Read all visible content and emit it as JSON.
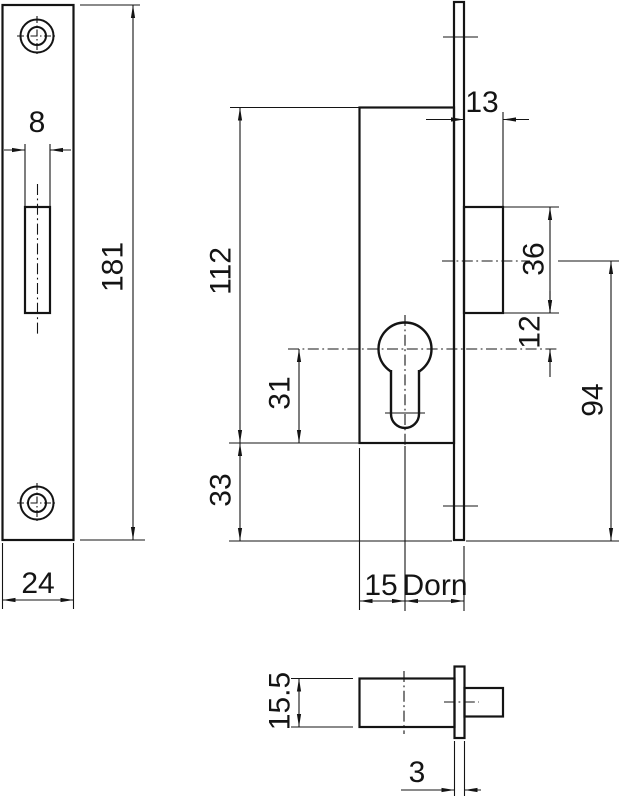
{
  "page": {
    "background": "#ffffff",
    "line_color": "#141414",
    "description": "Technical drawing of a narrow-stile mortise deadbolt lock with strike plate, front view and side view, dimensions in mm"
  },
  "views": {
    "strike_plate": {
      "title": "strike-plate-front-view",
      "dims": {
        "slot_width": "8",
        "plate_height": "181",
        "plate_width": "24"
      }
    },
    "lock_case": {
      "title": "lock-case-front-view",
      "dims": {
        "latch_projection": "13",
        "case_height": "112",
        "latch_height": "36",
        "latch_to_cylinder_axis": "12",
        "cylinder_axis_to_case_bottom": "31",
        "case_bottom_to_faceplate_end": "33",
        "latch_axis_to_faceplate_end": "94",
        "case_edge_to_cylinder_axis": "15",
        "backset_label": "Dorn"
      }
    },
    "latch_side": {
      "title": "latch-side-view",
      "dims": {
        "case_depth": "15.5",
        "faceplate_thickness": "3"
      }
    }
  }
}
